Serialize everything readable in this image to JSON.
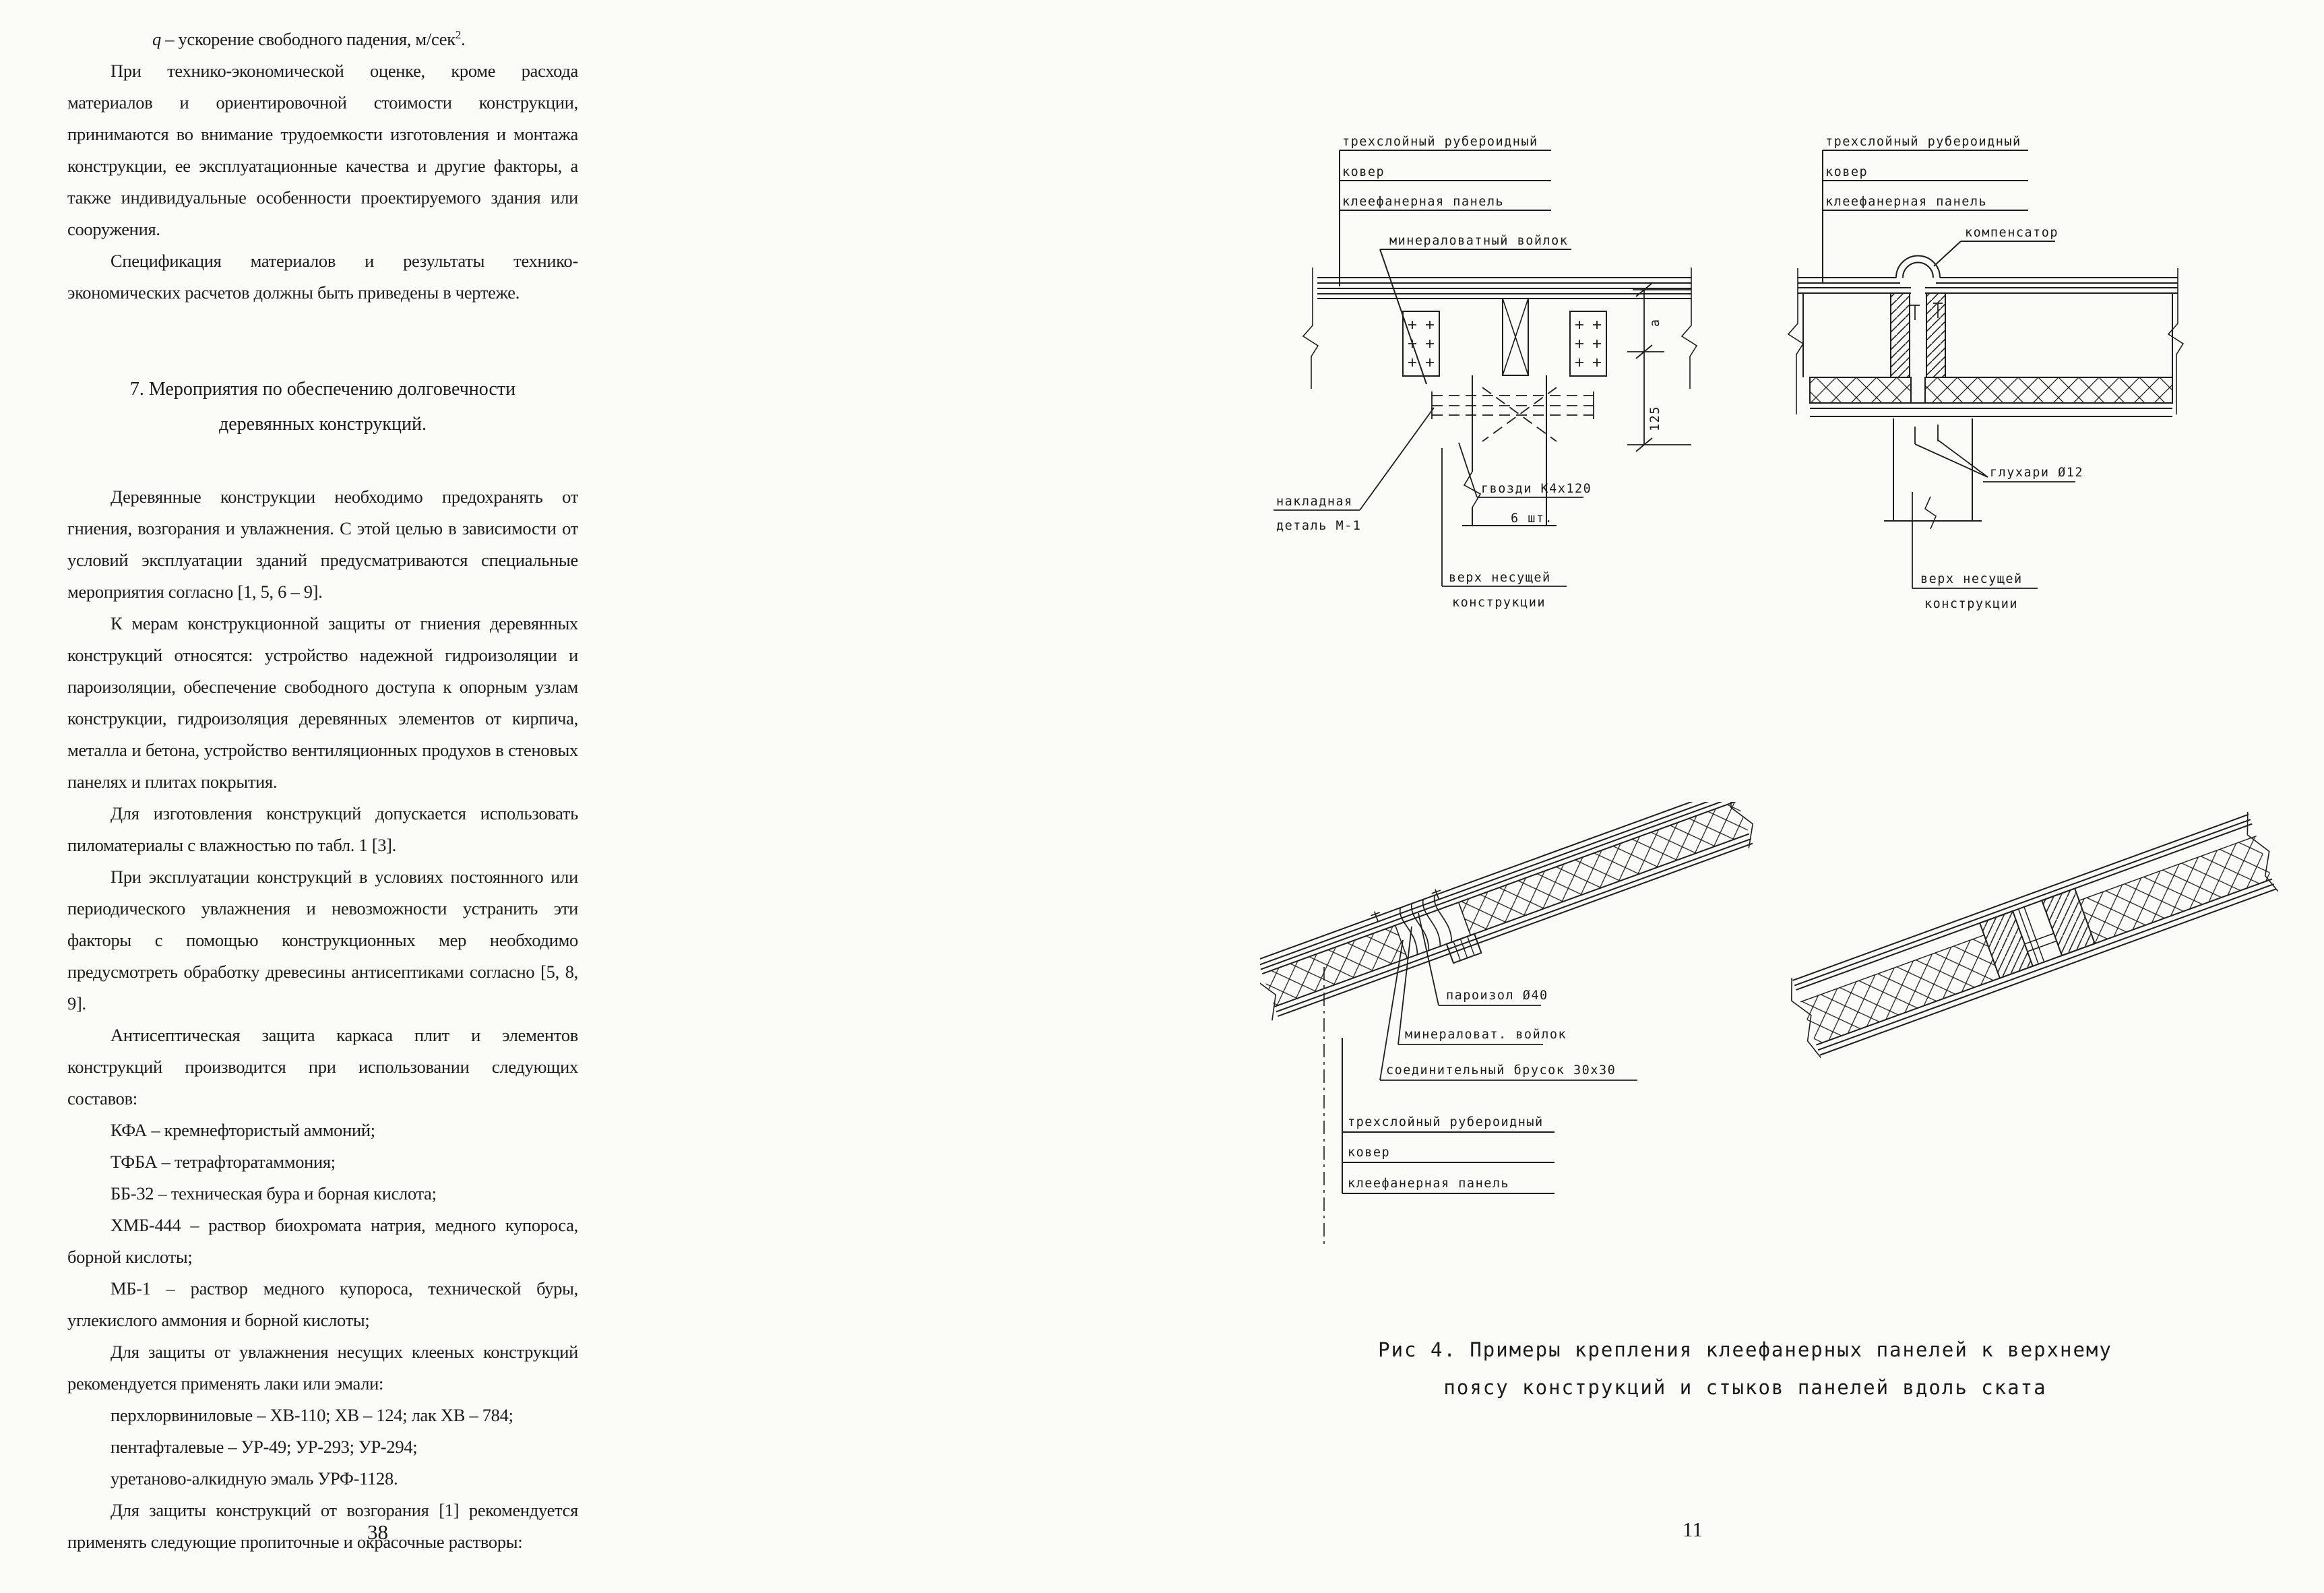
{
  "meta": {
    "paper_color": "#fbfbf8",
    "ink_color": "#1c1c1c"
  },
  "left_page": {
    "page_number": "38",
    "q_line": {
      "var": "q",
      "text": " – ускорение свободного падения, м/сек",
      "sup": "2",
      "period": "."
    },
    "paragraphs": [
      "При технико-экономической оценке, кроме расхода материалов и ориентировочной стоимости конструкции, принимаются во внимание трудоемкости изготовления и монтажа конструкции, ее эксплуатационные качества и другие факторы, а также индивидуальные особенности проектируемого здания или сооружения.",
      "Спецификация материалов и результаты технико-экономических расчетов должны быть приведены в чертеже."
    ],
    "heading": "7. Мероприятия по обеспечению долговечности деревянных конструкций.",
    "paragraphs2": [
      "Деревянные конструкции необходимо предохранять от гниения, возгорания и увлажнения. С этой целью в зависимости от условий эксплуатации зданий предусматриваются специальные мероприятия согласно [1, 5, 6 – 9].",
      "К мерам конструкционной защиты от гниения деревянных конструкций относятся: устройство надежной гидроизоляции и пароизоляции, обеспечение свободного доступа к опорным узлам конструкции, гидроизоляция деревянных элементов от кирпича, металла и бетона, устройство вентиляционных продухов в стеновых панелях и плитах покрытия.",
      "Для изготовления конструкций допускается использовать пиломатериалы с влажностью по табл. 1 [3].",
      "При эксплуатации конструкций в условиях постоянного или периодического увлажнения и невозможности устранить эти факторы с помощью конструкционных мер необходимо предусмотреть обработку древесины антисептиками согласно [5, 8, 9].",
      "Антисептическая защита каркаса плит и элементов конструкций производится при использовании следующих составов:",
      "КФА – кремнефтористый аммоний;",
      "ТФБА – тетрафторатаммония;",
      "ББ-32 – техническая бура и борная кислота;",
      "ХМБ-444 – раствор биохромата натрия, медного купороса, борной кислоты;",
      "МБ-1 – раствор медного купороса, технической буры, углекислого аммония и борной кислоты;",
      "Для защиты от увлажнения несущих клееных конструкций рекомендуется применять лаки или эмали:",
      "перхлорвиниловые – ХВ-110; ХВ – 124; лак ХВ – 784;",
      "пентафталевые – УР-49; УР-293; УР-294;",
      "уретаново-алкидную эмаль УРФ-1128.",
      "Для защиты конструкций от возгорания [1] рекомендуется применять следующие пропиточные и окрасочные растворы:"
    ]
  },
  "right_page": {
    "page_number": "11",
    "fig1": {
      "label_layer1": "трехслойный рубероидный",
      "label_layer2": "ковер",
      "label_layer3": "клеефанерная панель",
      "label_felt": "минераловатный войлок",
      "label_plate_line1": "накладная",
      "label_plate_line2": "деталь М-1",
      "label_nails_line1": "гвозди К4х120",
      "label_nails_line2": "6 шт.",
      "label_top_line1": "верх несущей",
      "label_top_line2": "конструкции",
      "dim_a": "а",
      "dim_125": "125"
    },
    "fig2": {
      "label_layer1": "трехслойный рубероидный",
      "label_layer2": "ковер",
      "label_layer3": "клеефанерная панель",
      "label_compensator": "компенсатор",
      "label_screws": "глухари Ø12",
      "label_top_line1": "верх несущей",
      "label_top_line2": "конструкции"
    },
    "fig3": {
      "label_poroizol": "пароизол Ø40",
      "label_felt": "минераловат. войлок",
      "label_bar": "соединительный брусок 30х30",
      "label_layer1": "трехслойный рубероидный",
      "label_layer2": "ковер",
      "label_layer3": "клеефанерная панель"
    },
    "caption_line1": "Рис 4. Примеры крепления клеефанерных панелей к верхнему",
    "caption_line2": "поясу конструкций и стыков панелей вдоль ската"
  }
}
